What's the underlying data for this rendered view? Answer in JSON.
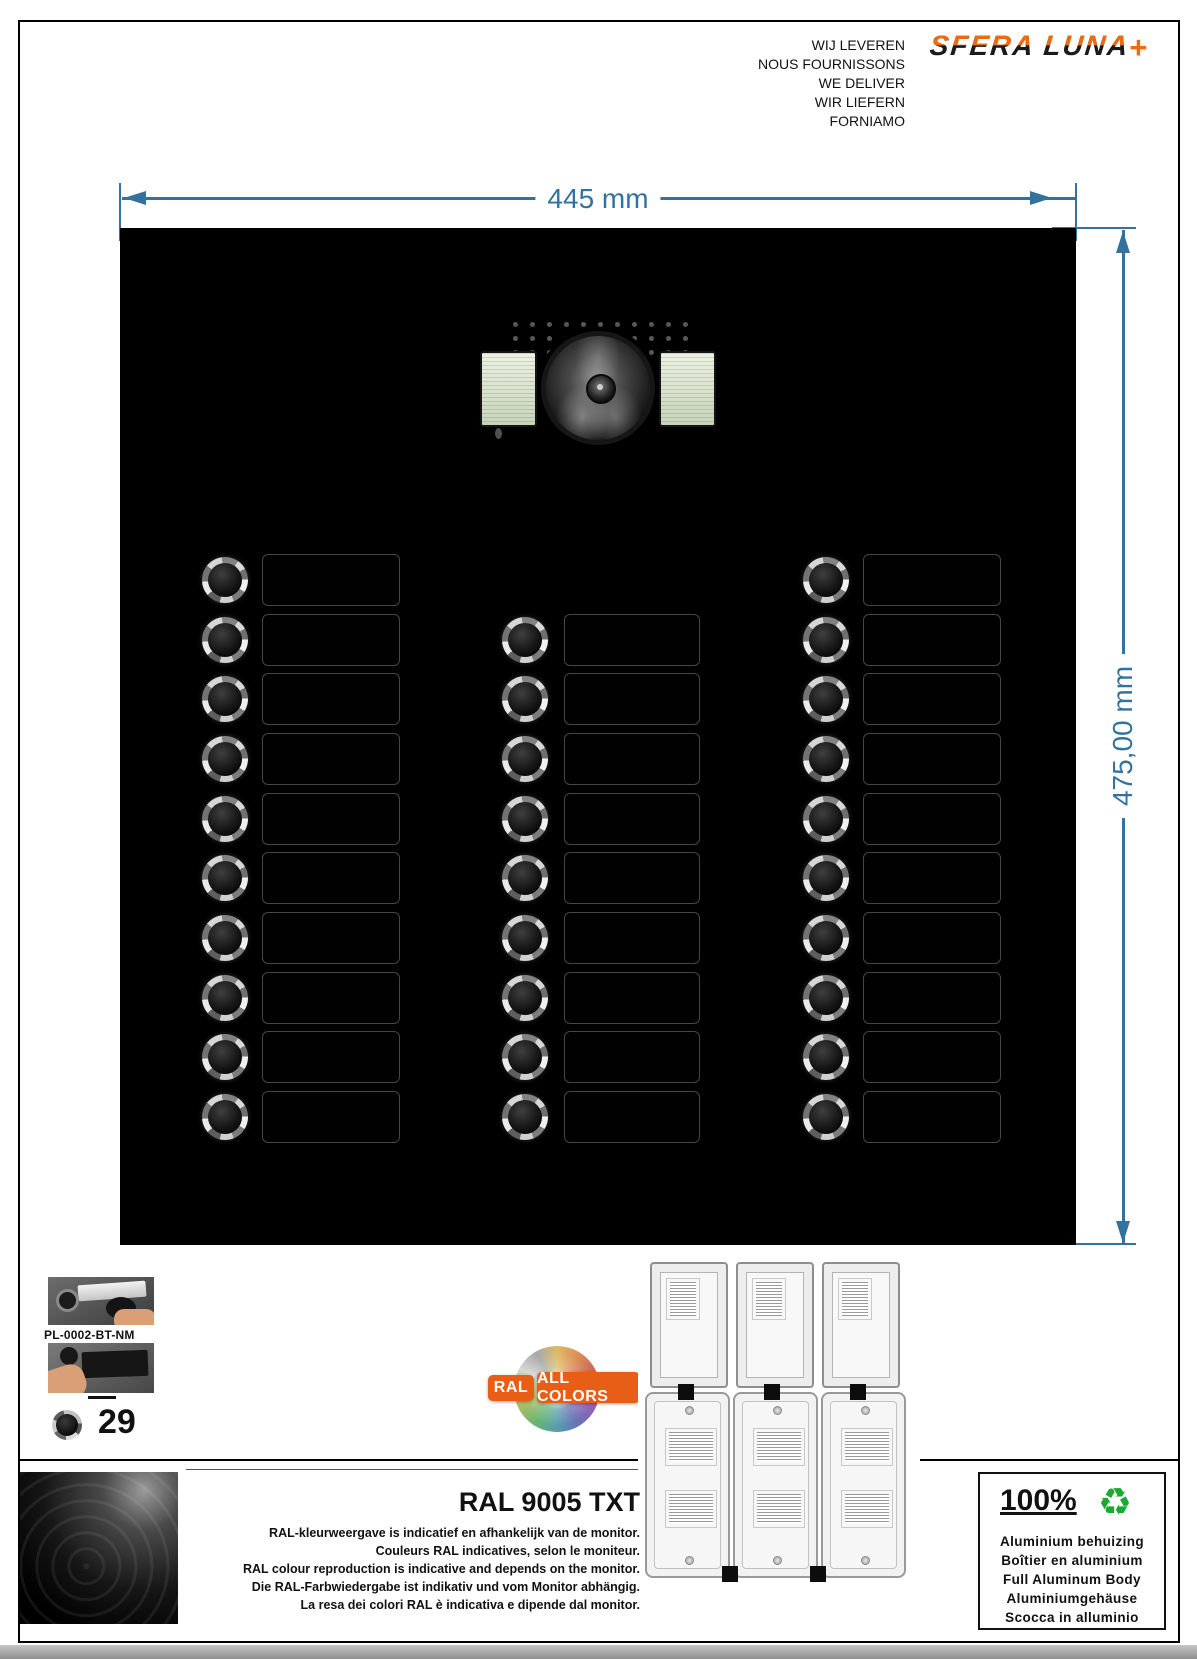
{
  "header": {
    "tagline_lines": [
      "WIJ LEVEREN",
      "NOUS FOURNISSONS",
      "WE DELIVER",
      "WIR LIEFERN",
      "FORNIAMO"
    ],
    "logo_text": "SFERA LUNA",
    "logo_plus": "+",
    "logo_orange": "#F06A10"
  },
  "dimensions": {
    "width_label": "445 mm",
    "height_label": "475,00 mm",
    "line_color": "#33729F"
  },
  "panel": {
    "columns": [
      {
        "name": "left",
        "buttons": 10,
        "start_row": 0
      },
      {
        "name": "middle",
        "buttons": 9,
        "start_row": 1
      },
      {
        "name": "right",
        "buttons": 10,
        "start_row": 0
      }
    ],
    "rows": 10,
    "speaker_grid": {
      "cols": 11,
      "rows": 4
    }
  },
  "product": {
    "code": "PL-0002-BT-NM",
    "button_count": "29"
  },
  "ral_badge": {
    "label_1": "RAL",
    "label_2": "ALL COLORS",
    "color": "#E95E17"
  },
  "ral_section": {
    "title": "RAL 9005 TXT",
    "disclaimer_lines": [
      "RAL-kleurweergave is indicatief en afhankelijk van de monitor.",
      "Couleurs RAL indicatives, selon le moniteur.",
      "RAL colour reproduction is indicative and depends on the monitor.",
      "Die RAL-Farbwiedergabe ist indikativ und vom Monitor abhängig.",
      "La resa dei colori RAL è indicativa e dipende dal monitor."
    ]
  },
  "material_box": {
    "percent": "100%",
    "recycle_icon": "♻",
    "recycle_color": "#1DA832",
    "lines": [
      "Aluminium behuizing",
      "Boîtier en aluminium",
      "Full Aluminum Body",
      "Aluminiumgehäuse",
      "Scocca in alluminio"
    ]
  }
}
